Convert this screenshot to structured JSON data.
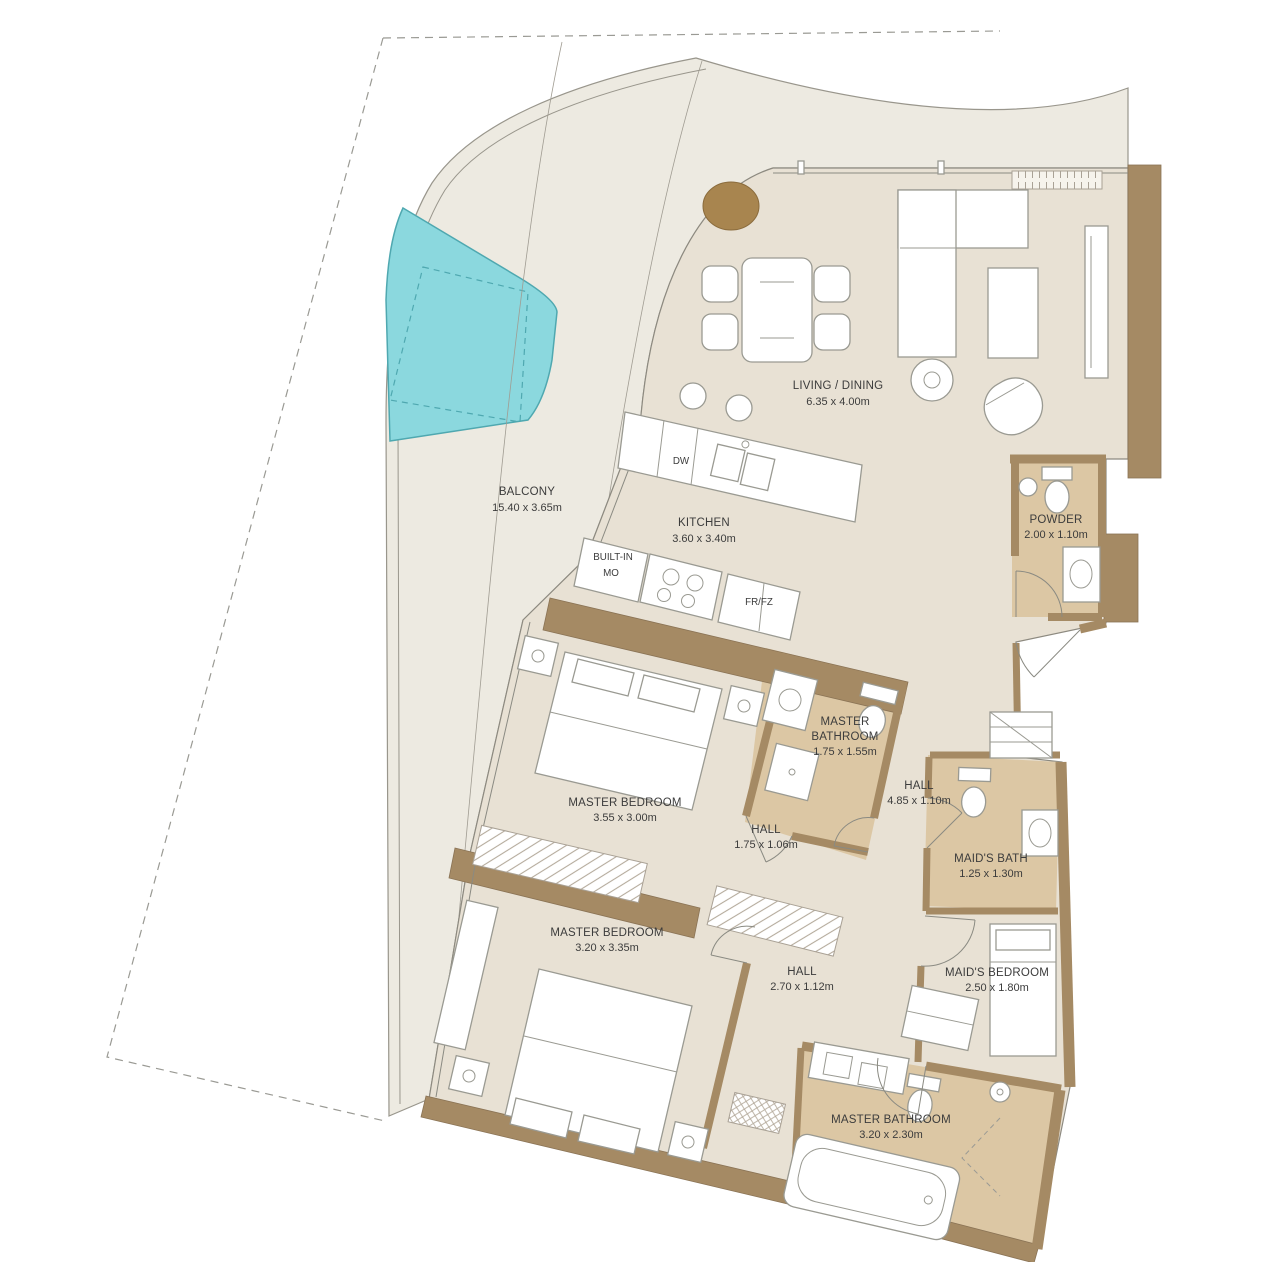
{
  "plan": {
    "rooms": [
      {
        "name": "BALCONY",
        "dims": "15.40 x 3.65m"
      },
      {
        "name": "LIVING / DINING",
        "dims": "6.35 x 4.00m"
      },
      {
        "name": "KITCHEN",
        "dims": "3.60 x 3.40m"
      },
      {
        "name": "POWDER",
        "dims": "2.00 x 1.10m"
      },
      {
        "name": "MASTER BATHROOM",
        "line1": "MASTER",
        "line2": "BATHROOM",
        "dims": "1.75 x 1.55m"
      },
      {
        "name": "HALL",
        "dims": "4.85 x 1.10m"
      },
      {
        "name": "MASTER BEDROOM",
        "dims": "3.55 x 3.00m"
      },
      {
        "name": "HALL",
        "dims": "1.75 x 1.06m"
      },
      {
        "name": "MAID'S BATH",
        "dims": "1.25 x 1.30m"
      },
      {
        "name": "MASTER BEDROOM",
        "dims": "3.20 x 3.35m"
      },
      {
        "name": "HALL",
        "dims": "2.70 x 1.12m"
      },
      {
        "name": "MAID'S BEDROOM",
        "dims": "2.50 x 1.80m"
      },
      {
        "name": "MASTER BATHROOM",
        "dims": "3.20 x 2.30m"
      }
    ],
    "appliances": {
      "dw": "DW",
      "built_in_1": "BUILT-IN",
      "built_in_2": "MO",
      "fridge": "FR/FZ"
    },
    "colors": {
      "wall": "#a58a64",
      "wall_dark": "#8a7355",
      "floor": "#e8e1d4",
      "floor_bath": "#dcc7a4",
      "floor_balcony": "#edeae1",
      "pool": "#8bd8de",
      "pool_line": "#4fa8b0",
      "line": "#8a8a82",
      "text": "#3c3c3c",
      "planter": "#a8854f",
      "furn": "#9a9a92"
    }
  }
}
